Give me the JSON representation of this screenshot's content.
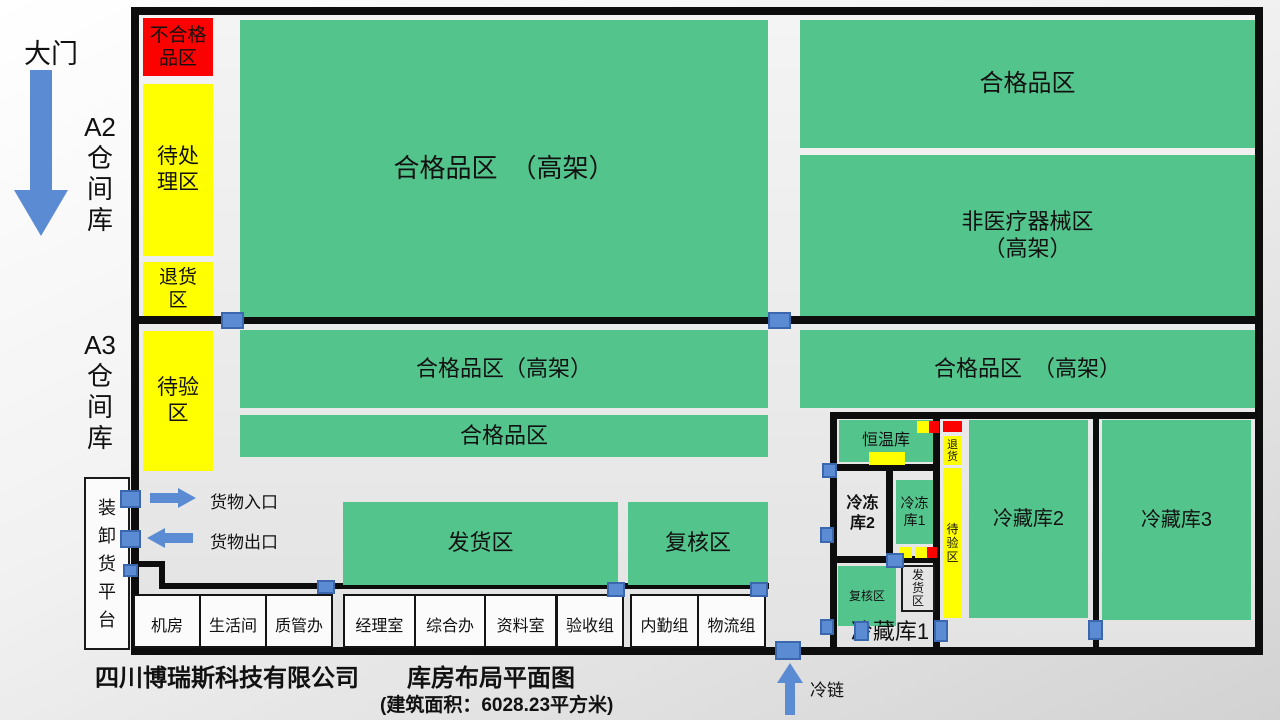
{
  "colors": {
    "zone_green": "#54C48D",
    "zone_yellow": "#FFFF00",
    "zone_red": "#FB0200",
    "arrow_blue": "#5B8BD3",
    "wall_black": "#0d0d0d"
  },
  "outside": {
    "gate": "大门",
    "a2_block": "A2\n仓\n间\n库",
    "a3_block": "A3\n仓\n间\n库",
    "platform": "装\n卸\n货\n平\n台",
    "goods_in": "货物入口",
    "goods_out": "货物出口",
    "cold_chain": "冷链"
  },
  "a2": {
    "unqualified": "不合格\n品区",
    "pending": "待处\n理区",
    "returns": "退货\n区",
    "qualified_rack": "合格品区　（高架）",
    "qualified_right": "合格品区",
    "non_medical": "非医疗器械区\n（高架）"
  },
  "a3": {
    "inspection": "待验\n区",
    "qualified_rack_left": "合格品区（高架）",
    "qualified_left": "合格品区",
    "qualified_rack_right": "合格品区　（高架）",
    "shipping": "发货区",
    "review": "复核区"
  },
  "offices": [
    "机房",
    "生活间",
    "质管办",
    "经理室",
    "综合办",
    "资料室",
    "验收组",
    "内勤组",
    "物流组"
  ],
  "cold": {
    "constant_temp": "恒温库",
    "freezer2": "冷冻\n库2",
    "freezer1": "冷冻\n库1",
    "review": "复核区",
    "shipping": "发\n货\n区",
    "strip_return": "退\n货",
    "strip_inspection": "待\n验\n区",
    "cold1": "冷藏库1",
    "cold2": "冷藏库2",
    "cold3": "冷藏库3"
  },
  "footer": {
    "title": "四川博瑞斯科技有限公司　　库房布局平面图",
    "subtitle": "(建筑面积：6028.23平方米)"
  }
}
